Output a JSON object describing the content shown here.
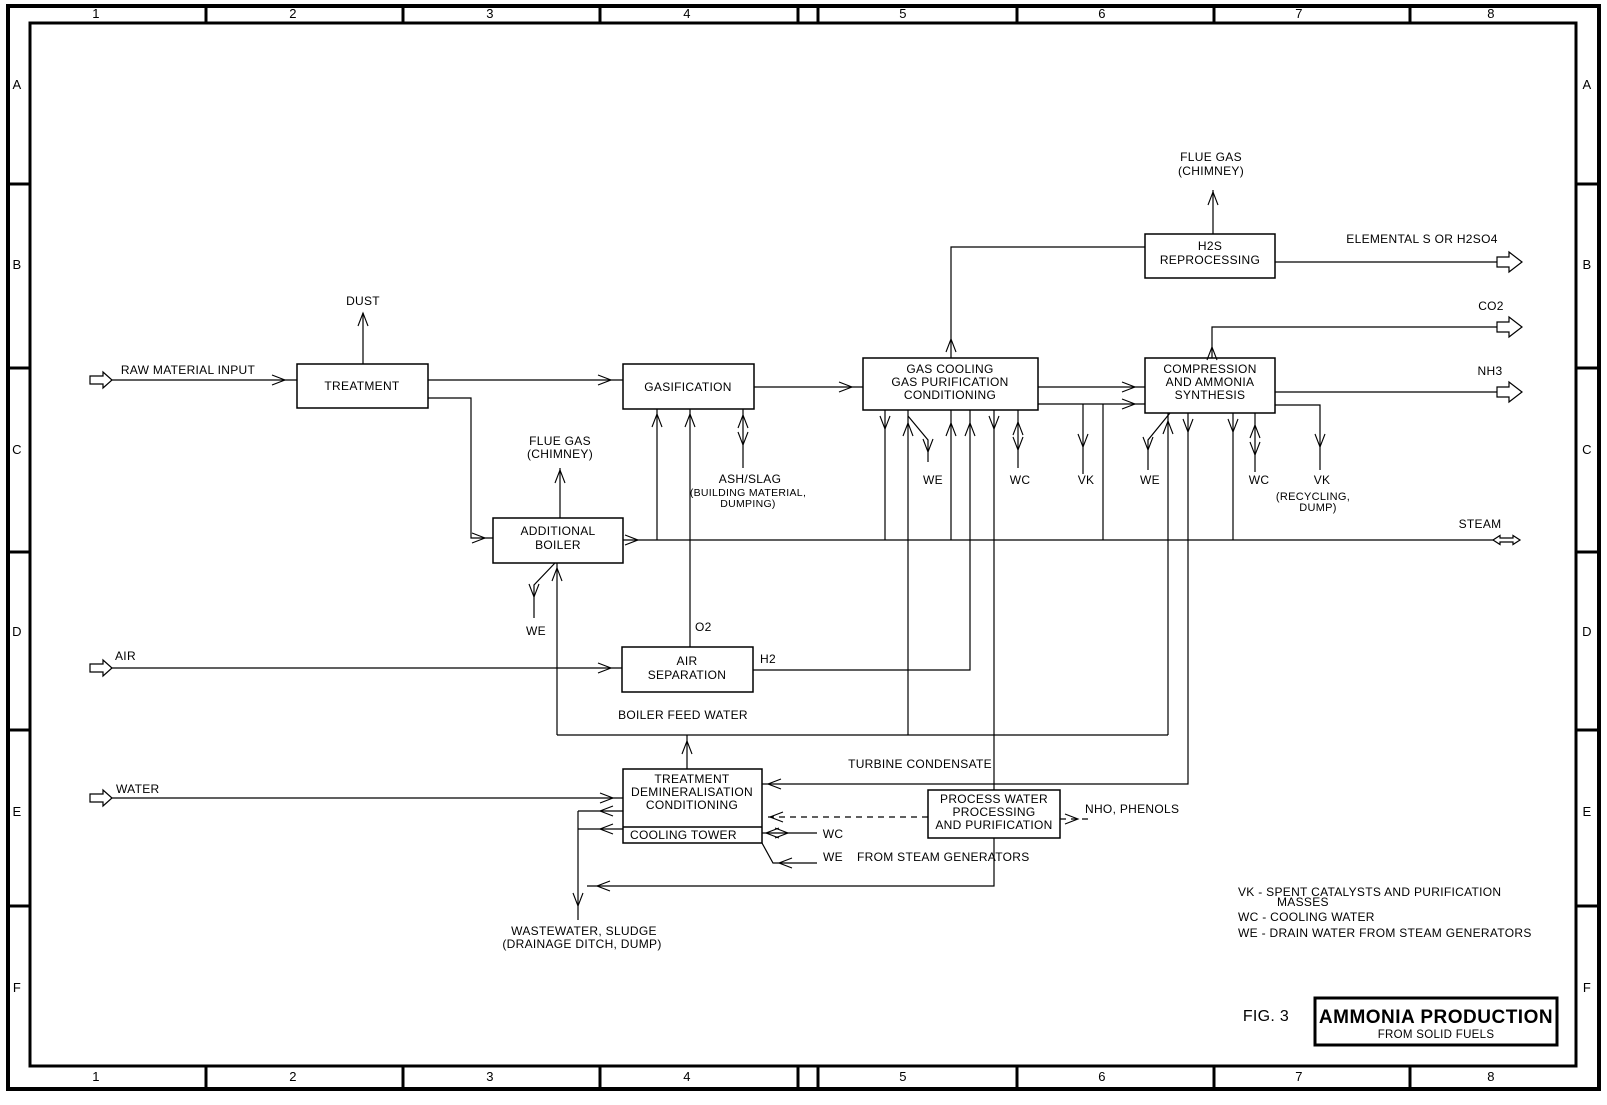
{
  "frame": {
    "cols": [
      "1",
      "2",
      "3",
      "4",
      "5",
      "6",
      "7",
      "8"
    ],
    "rows": [
      "A",
      "B",
      "C",
      "D",
      "E",
      "F"
    ]
  },
  "boxes": {
    "treatment": "TREATMENT",
    "gasification": "GASIFICATION",
    "gas_cooling": [
      "GAS COOLING",
      "GAS PURIFICATION",
      "CONDITIONING"
    ],
    "h2s_reprocessing": [
      "H2S",
      "REPROCESSING"
    ],
    "compression": [
      "COMPRESSION",
      "AND AMMONIA",
      "SYNTHESIS"
    ],
    "additional_boiler": [
      "ADDITIONAL",
      "BOILER"
    ],
    "air_separation": [
      "AIR",
      "SEPARATION"
    ],
    "demineralisation": [
      "TREATMENT",
      "DEMINERALISATION",
      "CONDITIONING"
    ],
    "cooling_tower": "COOLING TOWER",
    "process_water": [
      "PROCESS WATER",
      "PROCESSING",
      "AND PURIFICATION"
    ]
  },
  "streams": {
    "raw_material": "RAW MATERIAL INPUT",
    "dust": "DUST",
    "flue_gas": [
      "FLUE GAS",
      "(CHIMNEY)"
    ],
    "ash_slag": [
      "ASH/SLAG",
      "(BUILDING MATERIAL,",
      "DUMPING)"
    ],
    "elemental_s": "ELEMENTAL S OR H2SO4",
    "co2": "CO2",
    "nh3": "NH3",
    "steam": "STEAM",
    "o2": "O2",
    "h2": "H2",
    "air": "AIR",
    "water": "WATER",
    "boiler_feed_water": "BOILER FEED WATER",
    "turbine_condensate": "TURBINE CONDENSATE",
    "nho_phenols": "NHO, PHENOLS",
    "we": "WE",
    "wc": "WC",
    "vk": "VK",
    "vk_recycling": [
      "VK",
      "(RECYCLING,",
      "DUMP)"
    ],
    "wastewater": [
      "WASTEWATER, SLUDGE",
      "(DRAINAGE DITCH, DUMP)"
    ],
    "from_steam_generators": "FROM STEAM GENERATORS"
  },
  "legend": {
    "lines": [
      "VK  - SPENT CATALYSTS AND PURIFICATION",
      "MASSES",
      "WC - COOLING WATER",
      "WE - DRAIN WATER FROM STEAM GENERATORS"
    ]
  },
  "title_block": {
    "fig": "FIG. 3",
    "title": "AMMONIA PRODUCTION",
    "subtitle": "FROM SOLID FUELS"
  }
}
